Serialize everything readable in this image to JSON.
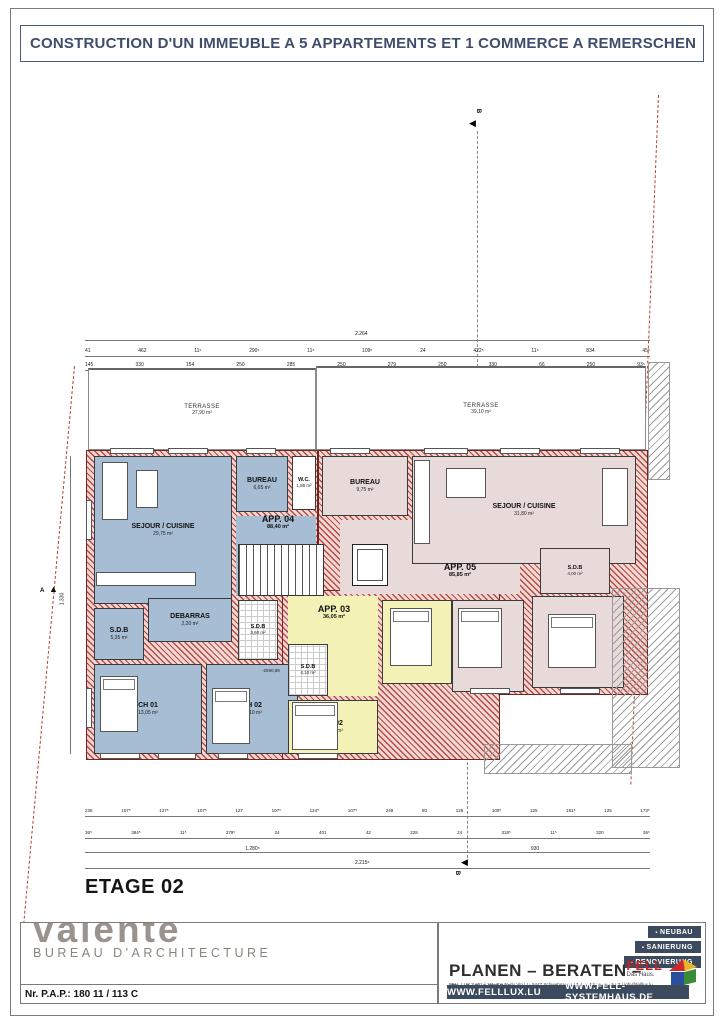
{
  "title": "CONSTRUCTION D'UN IMMEUBLE A 5 APPARTEMENTS ET 1 COMMERCE A REMERSCHEN",
  "floor_label": "ETAGE 02",
  "plan": {
    "terrace_left": {
      "name": "TERRASSE",
      "area": "27,90 m²"
    },
    "terrace_right": {
      "name": "TERRASSE",
      "area": "39,10 m²"
    },
    "app04": {
      "label": "APP. 04",
      "area": "88,40 m²",
      "sejour": {
        "name": "SEJOUR / CUISINE",
        "area": "29,75 m²"
      },
      "bureau": {
        "name": "BUREAU",
        "area": "6,65 m²"
      },
      "wc": {
        "name": "W.C.",
        "area": "1,85 m²"
      },
      "sdb1": {
        "name": "S.D.B",
        "area": "5,35 m²"
      },
      "debarras": {
        "name": "DEBARRAS",
        "area": "2,20 m²"
      },
      "sdb2": {
        "name": "S.D.B",
        "area": "3,60 m²"
      },
      "ch01": {
        "name": "CH 01",
        "area": "13,05 m²"
      },
      "ch02": {
        "name": "CH 02",
        "area": "13,10 m²"
      },
      "level_note": "-2590,88"
    },
    "app03": {
      "label": "APP. 03",
      "area": "36,05 m²",
      "sdb": {
        "name": "S.D.B",
        "area": "4,10 m²"
      },
      "ch01": {
        "name": "CH 01",
        "area": "12,85 m²"
      },
      "ch02": {
        "name": "CH 02",
        "area": "14,05 m²"
      }
    },
    "app05": {
      "label": "APP. 05",
      "area": "85,85 m²",
      "bureau": {
        "name": "BUREAU",
        "area": "9,75 m²"
      },
      "sejour": {
        "name": "SEJOUR / CUISINE",
        "area": "31,80 m²"
      },
      "sdb": {
        "name": "S.D.B",
        "area": "4,00 m²"
      },
      "ch01": {
        "name": "CH 01",
        "area": "14,00 m²"
      },
      "ch02": {
        "name": "CH 02",
        "area": "13,65 m²"
      }
    },
    "markers": {
      "a": "A",
      "b": "B"
    }
  },
  "dims": {
    "top_total": "2.264",
    "top_row2": [
      "41",
      "462",
      "11⁵",
      "290⁵",
      "11⁵",
      "109⁵",
      "24",
      "422⁵",
      "11⁵",
      "834",
      "45⁵"
    ],
    "top_row3": [
      "145",
      "330",
      "154",
      "250",
      "285",
      "250",
      "279",
      "250",
      "330",
      "66",
      "250",
      "93⁵"
    ],
    "left_v": "1.330",
    "bottom_row1": [
      "235",
      "107⁵",
      "127⁵",
      "107⁵",
      "127",
      "107⁵",
      "124⁵",
      "107⁵",
      "248",
      "80",
      "125",
      "109⁵",
      "125",
      "191⁵",
      "125",
      "173⁵"
    ],
    "bottom_row2": [
      "36⁵",
      "384⁵",
      "11⁵",
      "379⁵",
      "24",
      "401",
      "42",
      "228",
      "24",
      "318⁵",
      "11⁵",
      "320",
      "36⁵"
    ],
    "bottom_seg_left": "1.280⁵",
    "bottom_seg_right": "930",
    "bottom_total": "2.215⁵"
  },
  "footer": {
    "architect": {
      "logo": "valente",
      "subtitle": "BUREAU D'ARCHITECTURE",
      "pap": "Nr. P.A.P.: 180  11 / 113 C"
    },
    "fell": {
      "badges": [
        "NEUBAU",
        "SANIERUNG",
        "RENOVIERUNG"
      ],
      "slogan": "PLANEN – BERATEN – BAUEN",
      "address": "FELL LUX SARL | 111, Route du Vin | L- 5447 Schwebsange | Tel. +352 26 66 45 07 | info@felllux.lu",
      "web1": "WWW.FELLLUX.LU",
      "web2": "WWW.FELL-SYSTEMHAUS.DE",
      "brand": "FELL",
      "brand_sub": "Das Haus."
    }
  },
  "colors": {
    "app04_fill": "#a7bdd3",
    "app03_fill": "#f4f1b6",
    "app05_fill": "#e9dada",
    "wall_red": "#b94a44",
    "navy": "#3c4a5e",
    "title_blue": "#3e4d6b",
    "brand_red": "#c22222"
  }
}
